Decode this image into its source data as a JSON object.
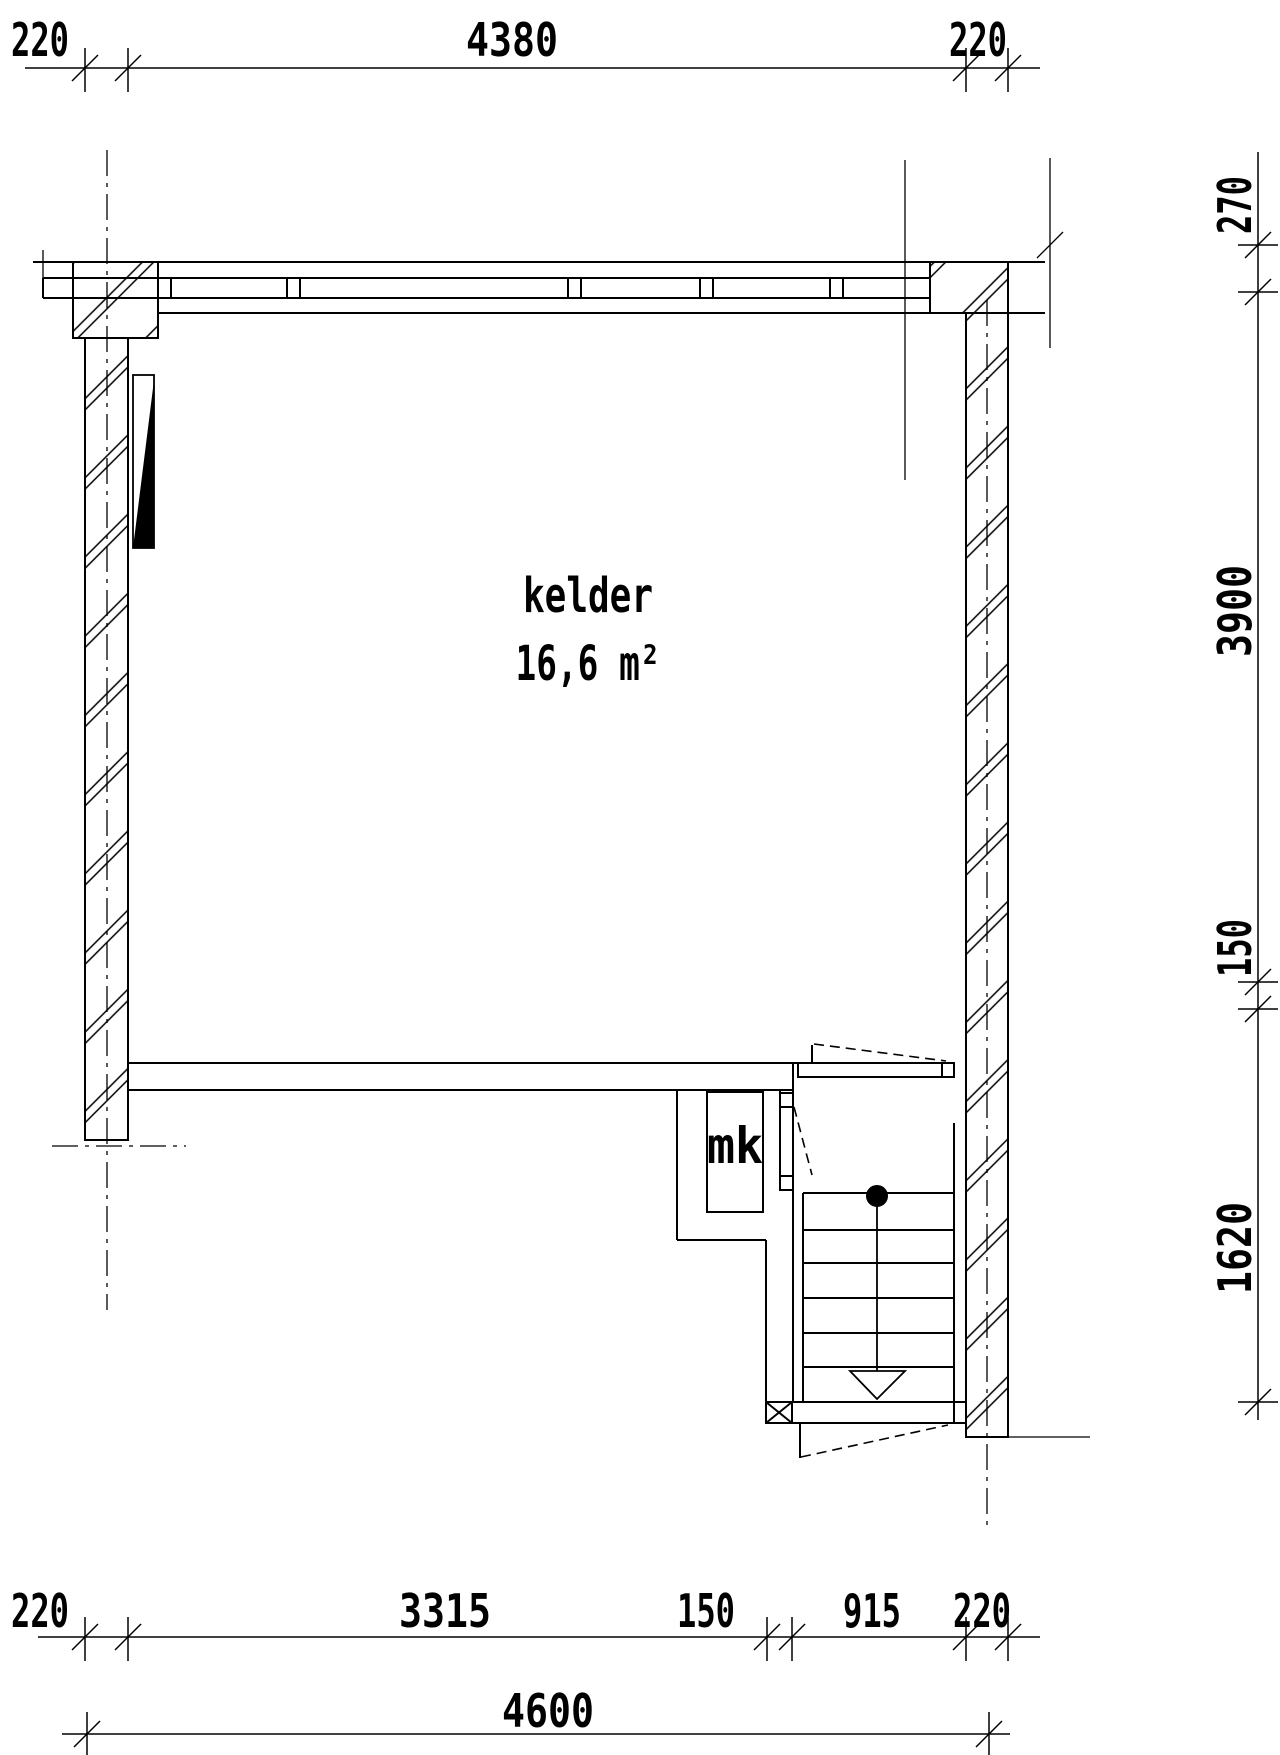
{
  "drawing": {
    "room": {
      "name": "kelder",
      "area": "16,6 m²"
    },
    "closet_label": "mk",
    "dims_top": {
      "left": "220",
      "span": "4380",
      "right": "220"
    },
    "dims_right": {
      "top": "270",
      "main": "3900",
      "wall": "150",
      "stair": "1620"
    },
    "dims_bottom": {
      "left": "220",
      "interior": "3315",
      "wall": "150",
      "stair": "915",
      "right": "220"
    },
    "dims_total": {
      "width": "4600"
    },
    "colors": {
      "line": "#000000",
      "background": "#ffffff"
    }
  }
}
